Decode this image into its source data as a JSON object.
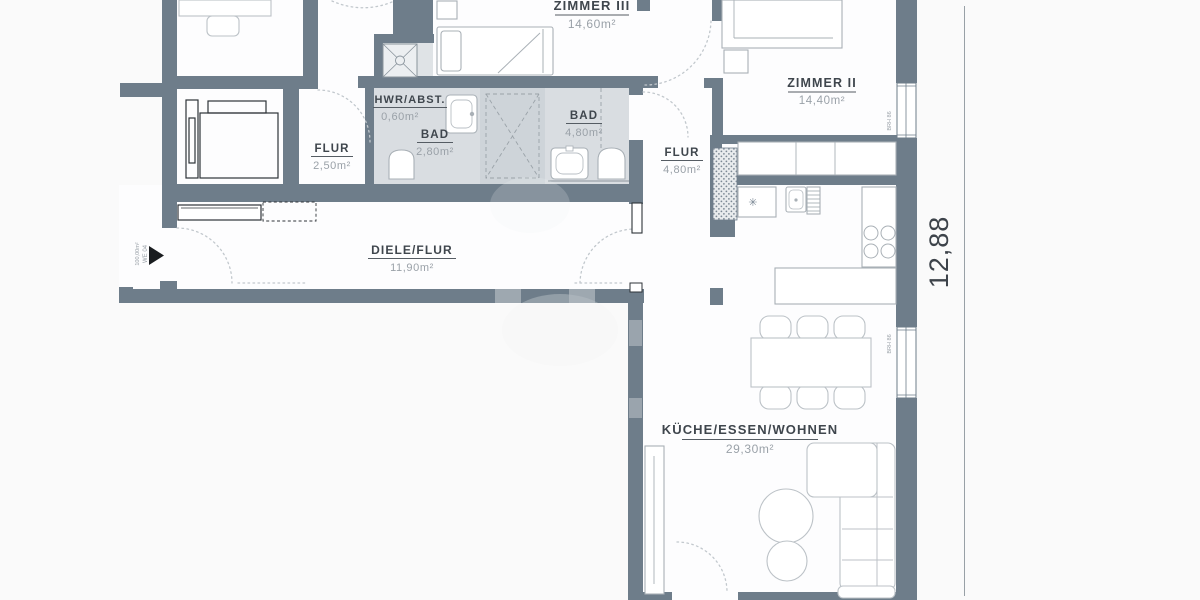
{
  "plan": {
    "title": "apartment-floor-plan",
    "rooms": [
      {
        "id": "zimmer3",
        "name": "ZIMMER III",
        "area": "14,60m²"
      },
      {
        "id": "zimmer2",
        "name": "ZIMMER II",
        "area": "14,40m²"
      },
      {
        "id": "hwr",
        "name": "HWR/ABST.",
        "area": "0,60m²"
      },
      {
        "id": "bad-klein",
        "name": "BAD",
        "area": "2,80m²"
      },
      {
        "id": "bad-gross",
        "name": "BAD",
        "area": "4,80m²"
      },
      {
        "id": "flur-klein",
        "name": "FLUR",
        "area": "2,50m²"
      },
      {
        "id": "flur-gross",
        "name": "FLUR",
        "area": "4,80m²"
      },
      {
        "id": "diele",
        "name": "DIELE/FLUR",
        "area": "11,90m²"
      },
      {
        "id": "wohnen",
        "name": "KÜCHE/ESSEN/WOHNEN",
        "area": "29,30m²"
      }
    ],
    "dimensions": {
      "right_vertical": "12,88"
    },
    "entrance": {
      "unit": "WE 04",
      "total_area": "100,00m²"
    },
    "windows": {
      "annotation_1": "BRH 86",
      "annotation_2": "BRH 86"
    },
    "colors": {
      "wall": "#6e7d8a",
      "bath_fill": "#d9dde1",
      "shaft_fill": "#ced4d9",
      "room_label": "#3f464d",
      "area_label": "#9aa1a8",
      "furniture_stroke": "#a9b0b6",
      "dark_furniture_stroke": "#2e3338",
      "door_arc": "#c2c8cd"
    }
  }
}
